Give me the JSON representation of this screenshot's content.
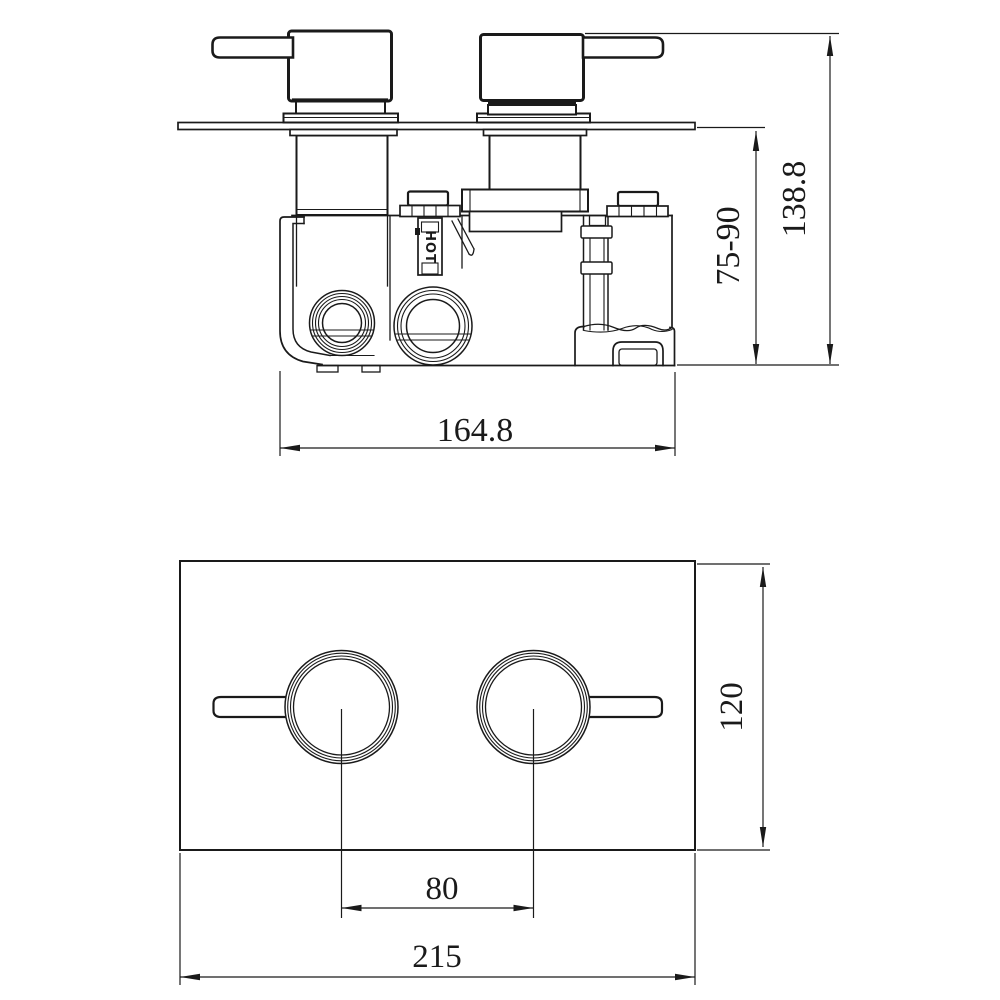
{
  "colors": {
    "background": "#ffffff",
    "line": "#1a1a1a"
  },
  "side_view": {
    "port_label": "HOT",
    "dimensions": {
      "width": "164.8",
      "depth_range": "75-90",
      "total_depth": "138.8"
    }
  },
  "front_view": {
    "dimensions": {
      "handle_spacing": "80",
      "plate_height": "120",
      "plate_width": "215"
    }
  }
}
